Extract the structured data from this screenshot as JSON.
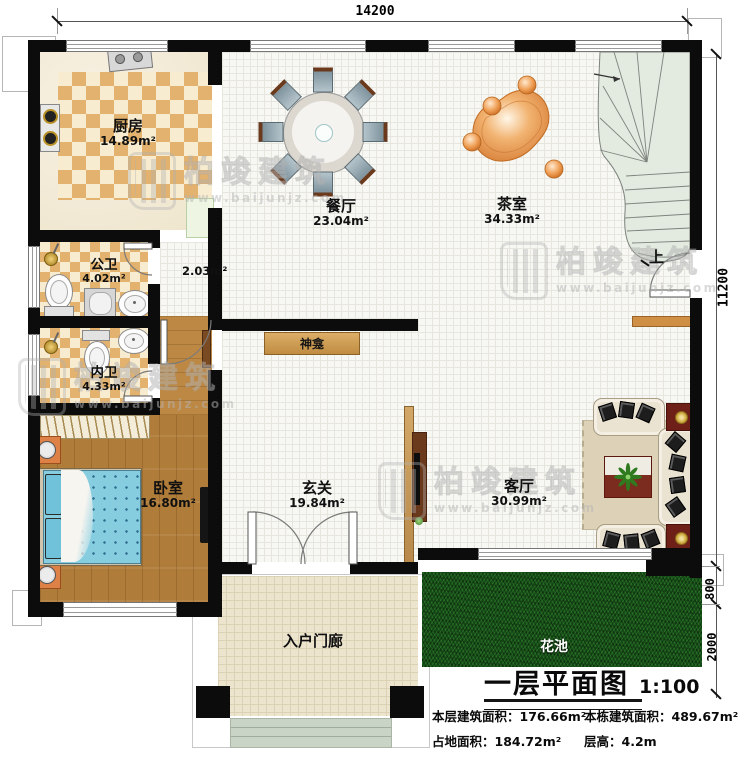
{
  "dimensions": {
    "width_top": "14200",
    "height_right": "11200",
    "flower_bed_depth": "800",
    "flower_bed_height": "2000"
  },
  "rooms": {
    "kitchen": {
      "name": "厨房",
      "area": "14.89m²"
    },
    "dining": {
      "name": "餐厅",
      "area": "23.04m²"
    },
    "tea": {
      "name": "茶室",
      "area": "34.33m²"
    },
    "public_bath": {
      "name": "公卫",
      "area": "4.02m²"
    },
    "private_bath": {
      "name": "内卫",
      "area": "4.33m²"
    },
    "bedroom": {
      "name": "卧室",
      "area": "16.80m²"
    },
    "foyer": {
      "name": "玄关",
      "area": "19.84m²"
    },
    "living": {
      "name": "客厅",
      "area": "30.99m²"
    },
    "hallway_area": "2.03m²",
    "shrine": "神龛",
    "porch": "入户门廊",
    "flower_bed": "花池",
    "stairs_up": "上"
  },
  "title_block": {
    "title": "一层平面图",
    "scale": "1:100",
    "stats": [
      {
        "label": "本层建筑面积：",
        "value": "176.66m²"
      },
      {
        "label": "本栋建筑面积：",
        "value": "489.67m²"
      },
      {
        "label": "占地面积：",
        "value": "184.72m²"
      },
      {
        "label": "层高：",
        "value": "4.2m"
      }
    ]
  },
  "watermark": {
    "brand": "柏竣建筑",
    "url": "www.baijunjz.com"
  },
  "colors": {
    "wall": "#0c0c0c",
    "wood": "#b07c3a",
    "tile": "#e2b26e",
    "grass": "#17541a",
    "stairs": "#e3eae0",
    "accent_orange": "#dd8146",
    "bed_blue": "#86cde0",
    "table_red": "#6e2018"
  }
}
